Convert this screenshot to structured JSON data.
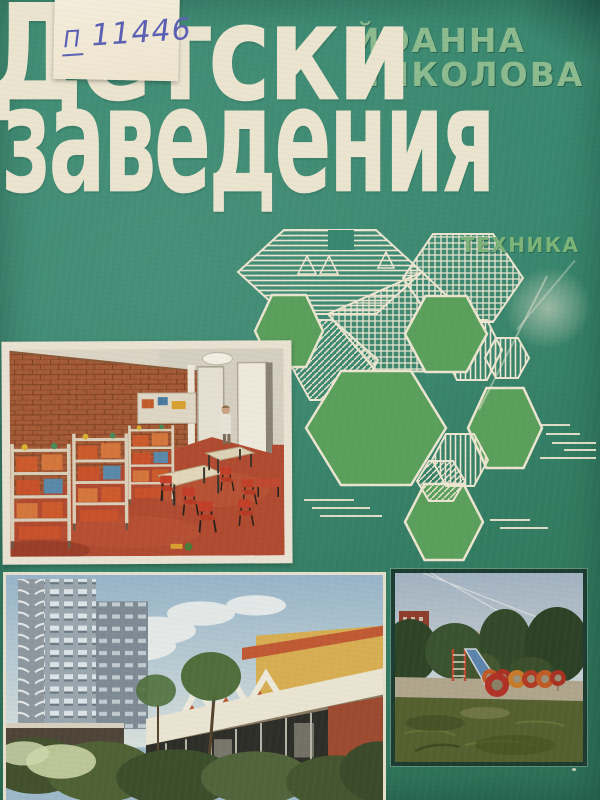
{
  "cover": {
    "library_sticker": {
      "prefix": "П",
      "number": "11446"
    },
    "title": {
      "line1": "Детски",
      "line2": "заведения"
    },
    "author": {
      "line1": "ЙОАННА",
      "line2": "НИКОЛОВА"
    },
    "publisher": {
      "name": "ТЕХНИКА"
    },
    "colors": {
      "background_green": "#38866e",
      "title_cream": "#ebe4cf",
      "author_green": "#8cbb8e",
      "publisher_green": "#7db478",
      "solid_hexagon_green": "#5b9f5c",
      "diagram_line_cream": "#ece5d0",
      "sticker_ink_blue": "#5c60b4"
    },
    "diagram": {
      "name": "hexagonal-kindergarten-plan-axonometric",
      "solid_hexagons": 5
    },
    "photos": [
      {
        "name": "playroom-interior-photo"
      },
      {
        "name": "kindergarten-building-photo"
      },
      {
        "name": "playground-photo"
      }
    ]
  }
}
